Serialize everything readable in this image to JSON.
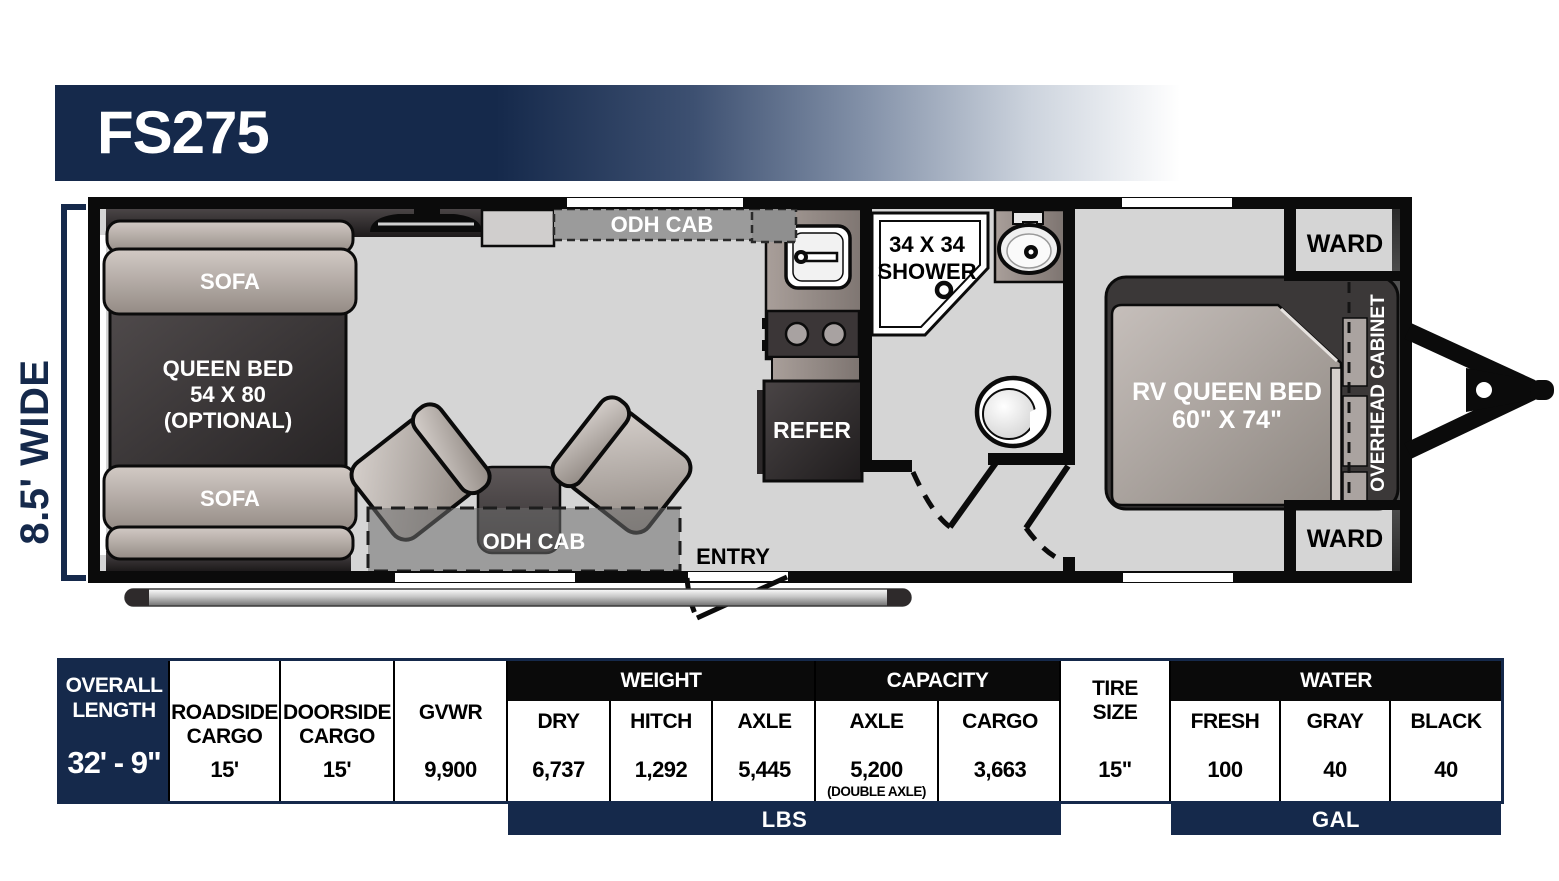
{
  "title": "FS275",
  "colors": {
    "navy": "#15294b",
    "wall_black": "#0d0d0d",
    "floor_gray": "#d5d5d5",
    "header_black": "#0a0a0a"
  },
  "floorplan": {
    "width_label": "8.5' WIDE",
    "sofa_top": "SOFA",
    "sofa_bottom": "SOFA",
    "queen_bed": {
      "line1": "QUEEN BED",
      "line2": "54 X 80",
      "line3": "(OPTIONAL)"
    },
    "odh_cab_top": "ODH CAB",
    "odh_cab_bottom": "ODH CAB",
    "shower": {
      "line1": "34 X 34",
      "line2": "SHOWER"
    },
    "refer": "REFER",
    "entry": "ENTRY",
    "rv_queen_bed": {
      "line1": "RV QUEEN BED",
      "line2": "60\" X 74\""
    },
    "overhead_cabinet": "OVERHEAD CABINET",
    "ward_top": "WARD",
    "ward_bottom": "WARD"
  },
  "specs": {
    "overall_length": {
      "label_line1": "OVERALL",
      "label_line2": "LENGTH",
      "value": "32' - 9\""
    },
    "roadside_cargo": {
      "label_line1": "ROADSIDE",
      "label_line2": "CARGO",
      "value": "15'"
    },
    "doorside_cargo": {
      "label_line1": "DOORSIDE",
      "label_line2": "CARGO",
      "value": "15'"
    },
    "gvwr": {
      "label": "GVWR",
      "value": "9,900"
    },
    "weight": {
      "header": "WEIGHT",
      "cols": [
        {
          "label": "DRY",
          "value": "6,737"
        },
        {
          "label": "HITCH",
          "value": "1,292"
        },
        {
          "label": "AXLE",
          "value": "5,445"
        }
      ]
    },
    "capacity": {
      "header": "CAPACITY",
      "cols": [
        {
          "label": "AXLE",
          "value": "5,200",
          "note": "(DOUBLE AXLE)"
        },
        {
          "label": "CARGO",
          "value": "3,663"
        }
      ]
    },
    "tire_size": {
      "label_line1": "TIRE",
      "label_line2": "SIZE",
      "value": "15\""
    },
    "water": {
      "header": "WATER",
      "cols": [
        {
          "label": "FRESH",
          "value": "100"
        },
        {
          "label": "GRAY",
          "value": "40"
        },
        {
          "label": "BLACK",
          "value": "40"
        }
      ]
    },
    "units_weight": "LBS",
    "units_water": "GAL"
  }
}
